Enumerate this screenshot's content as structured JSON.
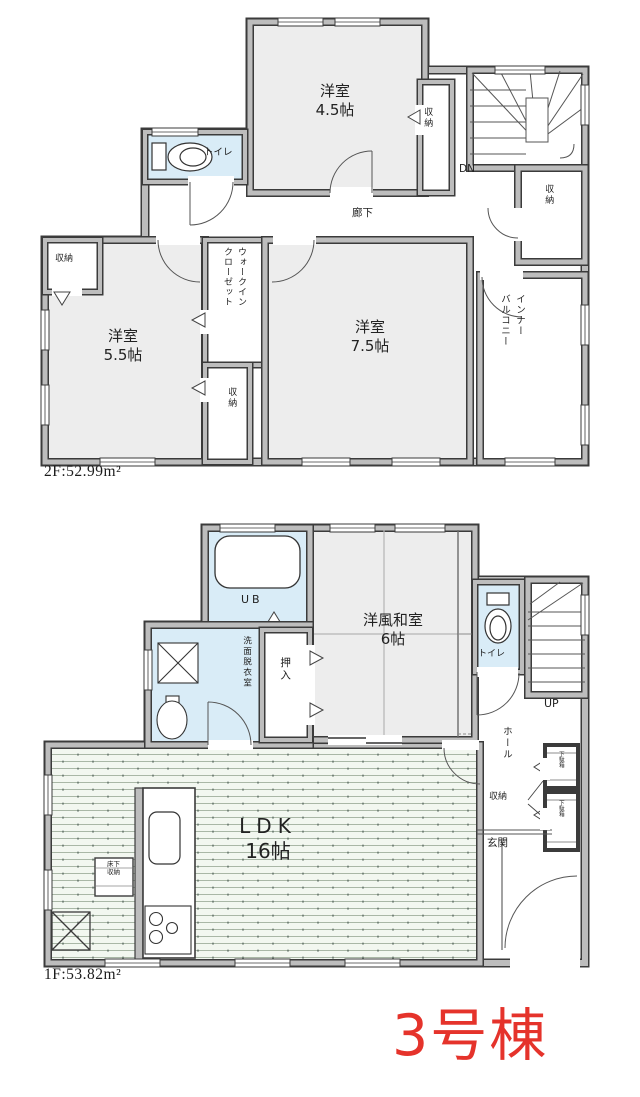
{
  "unit_label": "3号棟",
  "colors": {
    "accent_red": "#e5332b",
    "wet_room_fill": "#d9ecf7",
    "room_fill": "#ededed"
  },
  "floor2": {
    "area_label": "2F:52.99m²",
    "room45_name": "洋室",
    "room45_size": "4.5帖",
    "room55_name": "洋室",
    "room55_size": "5.5帖",
    "room75_name": "洋室",
    "room75_size": "7.5帖",
    "toilet": "トイレ",
    "hallway": "廊下",
    "storage": "収納",
    "down": "DN",
    "wic_col_right": "ウォークイン",
    "wic_col_left": "クローゼット",
    "balcony_col_right": "インナー",
    "balcony_col_left": "バルコニー"
  },
  "floor1": {
    "area_label": "1F:53.82m²",
    "unit_bath": "UB",
    "washroom": "洗面脱衣室",
    "oshiire": "押入",
    "washitsu_name": "洋風和室",
    "washitsu_size": "6帖",
    "toilet": "トイレ",
    "up": "UP",
    "hall": "ホール",
    "storage": "収納",
    "entrance": "玄関",
    "ldk_name": "LDK",
    "ldk_size": "16帖",
    "underfloor_storage": "床下収納",
    "shoe_box": "下駄箱"
  }
}
